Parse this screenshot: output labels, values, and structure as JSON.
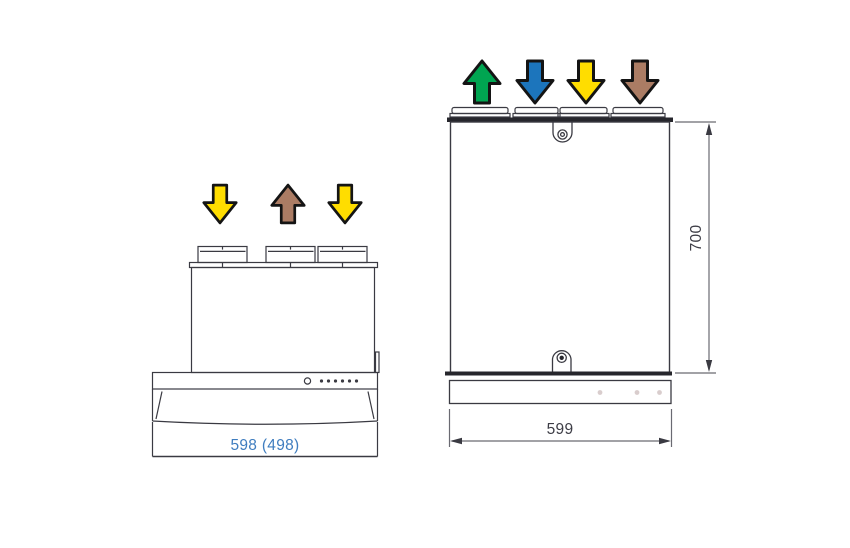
{
  "colors": {
    "line": "#3a3a42",
    "thick_edge": "#26262c",
    "dim_line": "#6a6a72",
    "arrow_outline": "#141414",
    "yellow": "#ffdd00",
    "brown": "#ab7c64",
    "green": "#00a551",
    "blue": "#1c75bc",
    "hood_dim_text": "#3f7dbf",
    "unit_dim_text": "#3d3d46",
    "strip_dot": "#d9cdcd"
  },
  "hood": {
    "width_label": "598 (498)",
    "spigot_count": 3,
    "indicator_dot_count": 6,
    "arrows": [
      {
        "direction": "down",
        "color": "#ffdd00"
      },
      {
        "direction": "up",
        "color": "#ab7c64"
      },
      {
        "direction": "down",
        "color": "#ffdd00"
      }
    ]
  },
  "unit": {
    "width_label": "599",
    "height_label": "700",
    "collar_count": 4,
    "strip_dot_count": 3,
    "arrows": [
      {
        "direction": "up",
        "color": "#00a551"
      },
      {
        "direction": "down",
        "color": "#1c75bc"
      },
      {
        "direction": "down",
        "color": "#ffdd00"
      },
      {
        "direction": "down",
        "color": "#ab7c64"
      }
    ]
  }
}
